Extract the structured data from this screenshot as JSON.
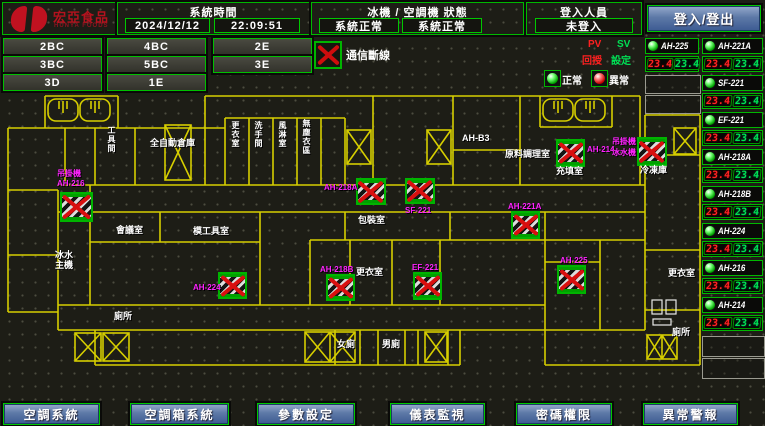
{
  "header": {
    "brand": {
      "name": "宏亞食品",
      "name_en": "HUNYA FOODS"
    },
    "clock": {
      "label": "系統時間",
      "date": "2024/12/12",
      "time": "22:09:51"
    },
    "machine_status": {
      "label": "冰機 / 空調機 狀態",
      "chiller": "系統正常",
      "ac": "系統正常"
    },
    "login": {
      "label": "登入人員",
      "user": "未登入",
      "button_label": "登入/登出"
    }
  },
  "floor_buttons": {
    "b1": "2BC",
    "b2": "4BC",
    "b3": "2E",
    "b4": "3BC",
    "b5": "5BC",
    "b6": "3E",
    "b7": "3D",
    "b8": "1E"
  },
  "legend": {
    "comm_loss": "通信斷線",
    "pv": "PV",
    "sv": "SV",
    "pv_name": "回授",
    "sv_name": "設定",
    "normal": "正常",
    "abnormal": "異常"
  },
  "unit_tiles": {
    "left": {
      "name": "AH-225",
      "pv": "23.4",
      "sv": "23.4"
    },
    "right": [
      {
        "name": "AH-221A",
        "pv": "23.4",
        "sv": "23.4"
      },
      {
        "name": "SF-221",
        "pv": "23.4",
        "sv": "23.4"
      },
      {
        "name": "EF-221",
        "pv": "23.4",
        "sv": "23.4"
      },
      {
        "name": "AH-218A",
        "pv": "23.4",
        "sv": "23.4"
      },
      {
        "name": "AH-218B",
        "pv": "23.4",
        "sv": "23.4"
      },
      {
        "name": "AH-224",
        "pv": "23.4",
        "sv": "23.4"
      },
      {
        "name": "AH-216",
        "pv": "23.4",
        "sv": "23.4"
      },
      {
        "name": "AH-214",
        "pv": "23.4",
        "sv": "23.4"
      }
    ]
  },
  "bottom_nav": {
    "b1": "空調系統",
    "b2": "空調箱系統",
    "b3": "參數設定",
    "b4": "儀表監視",
    "b5": "密碼權限",
    "b6": "異常警報"
  },
  "floorplan": {
    "labels": [
      {
        "text": "工具間"
      },
      {
        "text": "全自動倉庫"
      },
      {
        "text": "更衣室"
      },
      {
        "text": "洗手間"
      },
      {
        "text": "風淋室"
      },
      {
        "text": "無塵衣區"
      },
      {
        "text": "AH-B3"
      },
      {
        "text": "原料調理室"
      },
      {
        "text": "充填室"
      },
      {
        "text": "冷凍庫"
      },
      {
        "text": "包裝室"
      },
      {
        "text": "會議室"
      },
      {
        "text": "模工具室"
      },
      {
        "text": "冰水主機"
      },
      {
        "text": "更衣室"
      },
      {
        "text": "更衣室"
      },
      {
        "text": "廁所"
      },
      {
        "text": "女廁"
      },
      {
        "text": "男廁"
      },
      {
        "text": "廁所"
      }
    ],
    "unit_labels": [
      {
        "text": "吊掛機"
      },
      {
        "text": "AH-216"
      },
      {
        "text": "AH-218A"
      },
      {
        "text": "SF-221"
      },
      {
        "text": "AH-221A"
      },
      {
        "text": "AH-214"
      },
      {
        "text": "吊掛機"
      },
      {
        "text": "冰水機"
      },
      {
        "text": "AH-218B"
      },
      {
        "text": "EF-221"
      },
      {
        "text": "AH-224"
      },
      {
        "text": "AH-225"
      }
    ]
  },
  "colors": {
    "wall_yellow": "#d6ce00",
    "border_green": "#00b800",
    "alarm_red": "#d90f0f",
    "label_magenta": "#ff22ff",
    "pv_red": "#ff2323",
    "sv_green": "#00e055",
    "button_blue": "#3c5a92"
  }
}
